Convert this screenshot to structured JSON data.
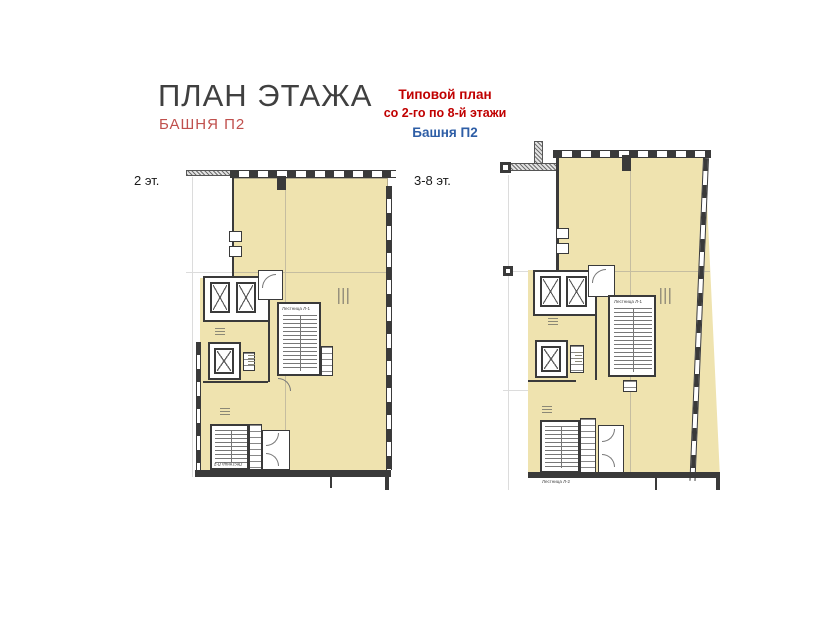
{
  "header": {
    "title": "ПЛАН ЭТАЖА",
    "subtitle": "БАШНЯ П2",
    "note": {
      "line1": "Типовой план",
      "line2": "со 2-го по 8-й этажи",
      "line3": "Башня П2"
    }
  },
  "plans": {
    "left": {
      "label": "2 эт.",
      "stair_top": "Лестница Л-1",
      "stair_bottom": "Лестница Л-2"
    },
    "right": {
      "label": "3-8 эт.",
      "stair_top": "Лестница Л-1",
      "stair_bottom": "Лестница Л-2"
    }
  },
  "colors": {
    "note_red": "#C00000",
    "subtitle_red": "#C0504D",
    "note_blue": "#2E5EA6",
    "floor_fill": "#EFE3AF",
    "wall_dark": "#3A3A3A"
  }
}
